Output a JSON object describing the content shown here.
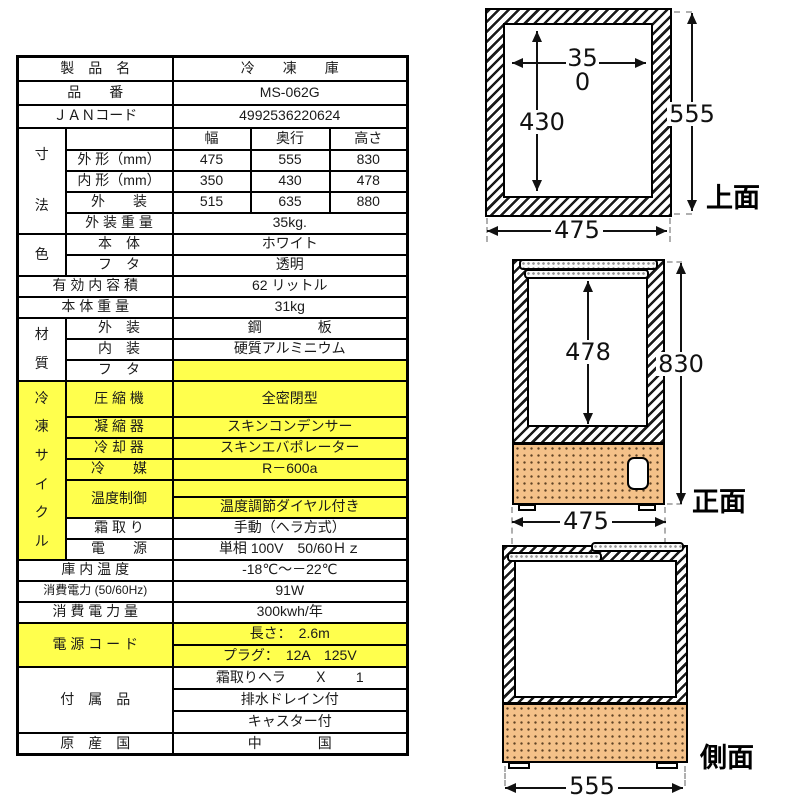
{
  "colors": {
    "highlight_yellow": "#ffff4d",
    "machine_compartment": "#f4c189",
    "line_black": "#111111"
  },
  "spec_table": {
    "product_name": {
      "label": "製　品　名",
      "value": "冷　　凍　　庫"
    },
    "model_number": {
      "label": "品　　番",
      "value": "MS-062G"
    },
    "jan_code": {
      "label": "ＪＡＮコード",
      "value": "4992536220624"
    },
    "dimensions": {
      "group_chars": [
        "寸",
        "法"
      ],
      "columns": {
        "width": "幅",
        "depth": "奥行",
        "height": "高さ"
      },
      "outer": {
        "label": "外 形（mm）",
        "width": "475",
        "depth": "555",
        "height": "830"
      },
      "inner": {
        "label": "内 形（mm）",
        "width": "350",
        "depth": "430",
        "height": "478"
      },
      "packaged": {
        "label": "外　　装",
        "width": "515",
        "depth": "635",
        "height": "880"
      },
      "packaged_weight": {
        "label": "外 装 重 量",
        "value": "35kg."
      }
    },
    "color_section": {
      "group": "色",
      "body": {
        "label": "本　体",
        "value": "ホワイト"
      },
      "lid": {
        "label": "フ　タ",
        "value": "透明"
      }
    },
    "capacity": {
      "label": "有 効 内 容 積",
      "value": "62 リットル"
    },
    "body_weight": {
      "label": "本 体 重 量",
      "value": "31kg"
    },
    "material": {
      "group_chars": [
        "材",
        "質"
      ],
      "exterior": {
        "label": "外　装",
        "value": "鋼　　　　板"
      },
      "interior": {
        "label": "内　装",
        "value": "硬質アルミニウム"
      },
      "lid": {
        "label": "フ　タ",
        "value": ""
      }
    },
    "refrigeration_cycle": {
      "group_chars": [
        "冷",
        "凍",
        "サ",
        "イ",
        "ク",
        "ル"
      ],
      "compressor": {
        "label": "圧 縮 機",
        "value": "全密閉型"
      },
      "condenser": {
        "label": "凝 縮 器",
        "value": "スキンコンデンサー"
      },
      "evaporator": {
        "label": "冷 却 器",
        "value": "スキンエバポレーター"
      },
      "refrigerant": {
        "label": "冷　　媒",
        "value": "R－600a"
      },
      "temperature_control": {
        "label": "温度制御",
        "value_top": "",
        "value": "温度調節ダイヤル付き"
      },
      "defrost": {
        "label": "霜 取 り",
        "value": "手動（ヘラ方式）"
      },
      "power": {
        "label": "電　　源",
        "value": "単相 100V　50/60Ｈｚ"
      }
    },
    "inside_temperature": {
      "label": "庫 内 温 度",
      "value": "-18℃～－22℃"
    },
    "power_consumption": {
      "label": "消費電力 (50/60Hz)",
      "value": "91W"
    },
    "annual_energy": {
      "label": "消 費 電 力 量",
      "value": "300kwh/年"
    },
    "power_cord": {
      "label": "電 源 コ ー ド",
      "length": "長さ：　2.6m",
      "plug": "プラグ：　12A　125V"
    },
    "accessories": {
      "label": "付　属　品",
      "items": [
        "霜取りヘラ　　Ｘ　　1",
        "排水ドレイン付",
        "キャスター付"
      ]
    },
    "origin": {
      "label": "原　産　国",
      "value": "中　　　　国"
    }
  },
  "figures": {
    "top_view": {
      "view_label": "上面",
      "inner_width_mm": "350",
      "inner_depth_mm": "430",
      "outer_depth_mm": "555",
      "outer_width_mm": "475"
    },
    "front_view": {
      "view_label": "正面",
      "inner_height_mm": "478",
      "outer_height_mm": "830",
      "outer_width_mm": "475"
    },
    "side_view": {
      "view_label": "側面",
      "outer_depth_mm": "555"
    }
  }
}
